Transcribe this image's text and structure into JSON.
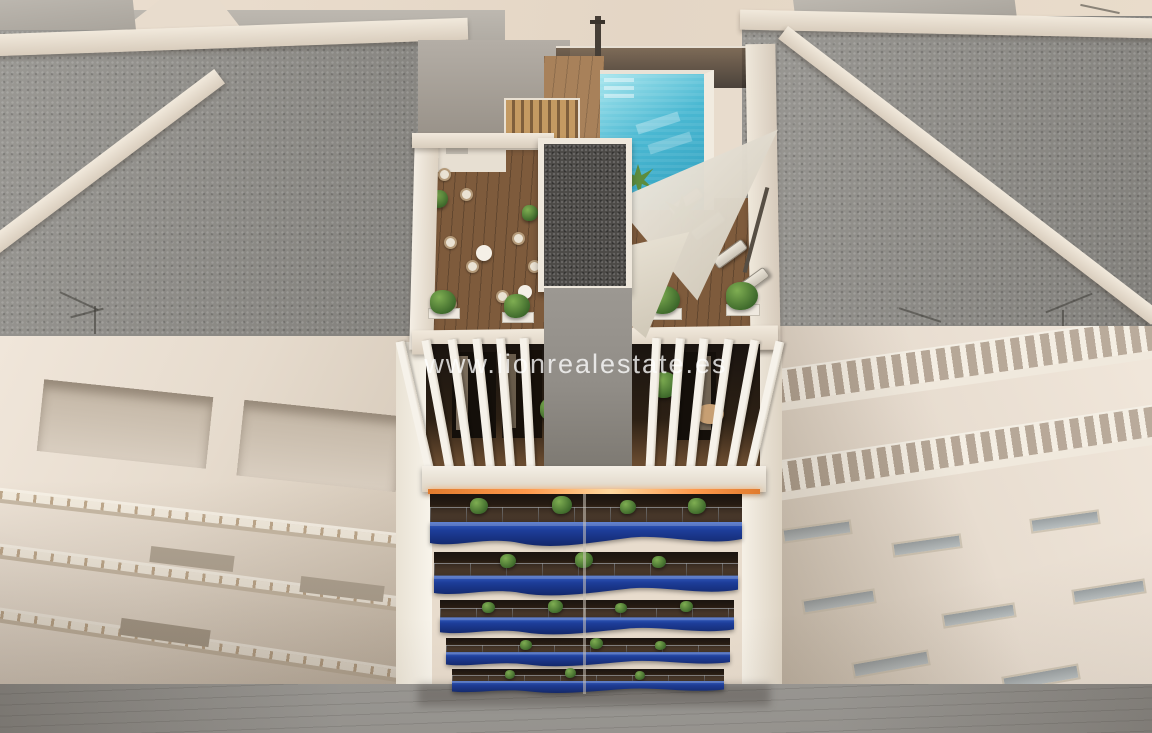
{
  "watermark": {
    "text": "www.lionrealestate.es"
  },
  "palette": {
    "cream": "#e8dccd",
    "cream-dark": "#d4c6b6",
    "gravel": "#8f8d88",
    "parapet": "#f1e9dc",
    "facade": "#ecdfd0",
    "facade-shadow": "#c9bcab",
    "street": "#908e8a",
    "pool-light": "#a8e6ee",
    "pool": "#4ab8d2",
    "pool-deep": "#2f9dbd",
    "deck": "#7e5b3c",
    "wood-slat": "#c49a62",
    "blue-light": "#3560c4",
    "blue-mid": "#1d3d99",
    "blue-deep": "#12276b",
    "glass-dark": "#23262b",
    "plant-dark": "#3c672a",
    "plant-light": "#7fae52",
    "sail": "#f2eee6",
    "led": "#ff9a4d",
    "core-gray": "#918d87",
    "core-gravel": "#4c4a47",
    "interior": "#1a1410",
    "watermark": "#ffffff"
  }
}
